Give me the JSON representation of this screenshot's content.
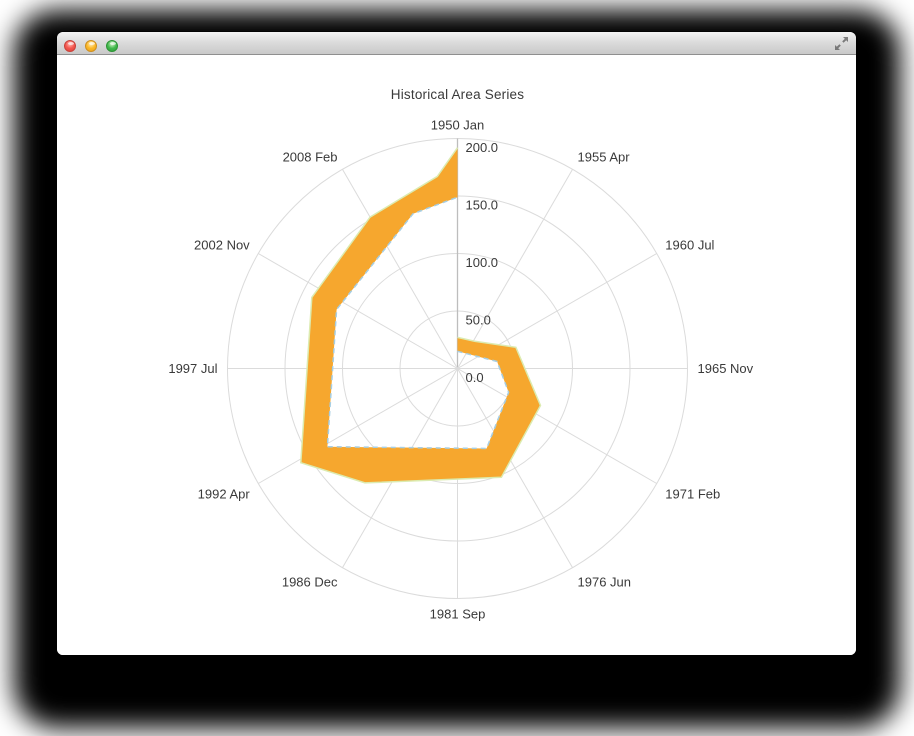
{
  "window": {
    "title": "",
    "controls": [
      {
        "name": "close",
        "color": "#F4574E"
      },
      {
        "name": "minimize",
        "color": "#FBB827"
      },
      {
        "name": "zoom",
        "color": "#43BA4D"
      }
    ],
    "fullscreen_icon": "expand-diagonal-arrows"
  },
  "chart_data": {
    "type": "area",
    "polar": true,
    "title": "Historical Area Series",
    "legend": false,
    "grid": true,
    "radial_range": [
      0,
      200
    ],
    "radial_ticks": [
      {
        "value": 0,
        "label": "0.0"
      },
      {
        "value": 50,
        "label": "50.0"
      },
      {
        "value": 100,
        "label": "100.0"
      },
      {
        "value": 150,
        "label": "150.0"
      },
      {
        "value": 200,
        "label": "200.0"
      }
    ],
    "categories": [
      {
        "label": "1950 Jan",
        "deg": 0
      },
      {
        "label": "1955 Apr",
        "deg": 30
      },
      {
        "label": "1960 Jul",
        "deg": 60
      },
      {
        "label": "1965 Nov",
        "deg": 90
      },
      {
        "label": "1971 Feb",
        "deg": 120
      },
      {
        "label": "1976 Jun",
        "deg": 150
      },
      {
        "label": "1981 Sep",
        "deg": 180
      },
      {
        "label": "1986 Dec",
        "deg": 210
      },
      {
        "label": "1992 Apr",
        "deg": 240
      },
      {
        "label": "1997 Jul",
        "deg": 270
      },
      {
        "label": "2002 Nov",
        "deg": 300
      },
      {
        "label": "2008 Feb",
        "deg": 330
      }
    ],
    "band": {
      "note": "closed range band spiraling outward clockwise from the center; vertices are [angle_deg_clockwise_from_top, value]",
      "outer_vertices": [
        [
          0,
          27
        ],
        [
          32,
          28
        ],
        [
          70,
          54
        ],
        [
          114,
          79
        ],
        [
          158,
          102
        ],
        [
          219,
          128
        ],
        [
          239,
          159
        ],
        [
          296,
          141
        ],
        [
          330,
          152
        ],
        [
          354,
          168
        ],
        [
          360,
          192
        ]
      ],
      "inner_vertices": [
        [
          0,
          15
        ],
        [
          80,
          35
        ],
        [
          115,
          49
        ],
        [
          160,
          74
        ],
        [
          239,
          132
        ],
        [
          296,
          117
        ],
        [
          344,
          140
        ],
        [
          360,
          149
        ]
      ]
    },
    "per_category_readings": [
      {
        "category": "1950 Jan",
        "low": 15,
        "high": 27
      },
      {
        "category": "1955 Apr",
        "low": 16,
        "high": 28
      },
      {
        "category": "1960 Jul",
        "low": 21,
        "high": 41
      },
      {
        "category": "1965 Nov",
        "low": 37,
        "high": 59
      },
      {
        "category": "1971 Feb",
        "low": 50,
        "high": 79
      },
      {
        "category": "1976 Jun",
        "low": 63,
        "high": 92
      },
      {
        "category": "1981 Sep",
        "low": 70,
        "high": 96
      },
      {
        "category": "1986 Dec",
        "low": 80,
        "high": 114
      },
      {
        "category": "1992 Apr",
        "low": 132,
        "high": 159
      },
      {
        "category": "1997 Jul",
        "low": 108,
        "high": 132
      },
      {
        "category": "2002 Nov",
        "low": 116,
        "high": 140
      },
      {
        "category": "2008 Feb",
        "low": 123,
        "high": 152
      },
      {
        "category": "1950 Jan (cycle end)",
        "low": 149,
        "high": 192
      }
    ],
    "colors": {
      "band_fill": "#F6A72E",
      "high_line": "#DCEBB0",
      "low_line": "#A6CEE3",
      "grid": "#DBDBDB",
      "axis": "#BDBDBD",
      "text": "#3A3A3A"
    }
  }
}
